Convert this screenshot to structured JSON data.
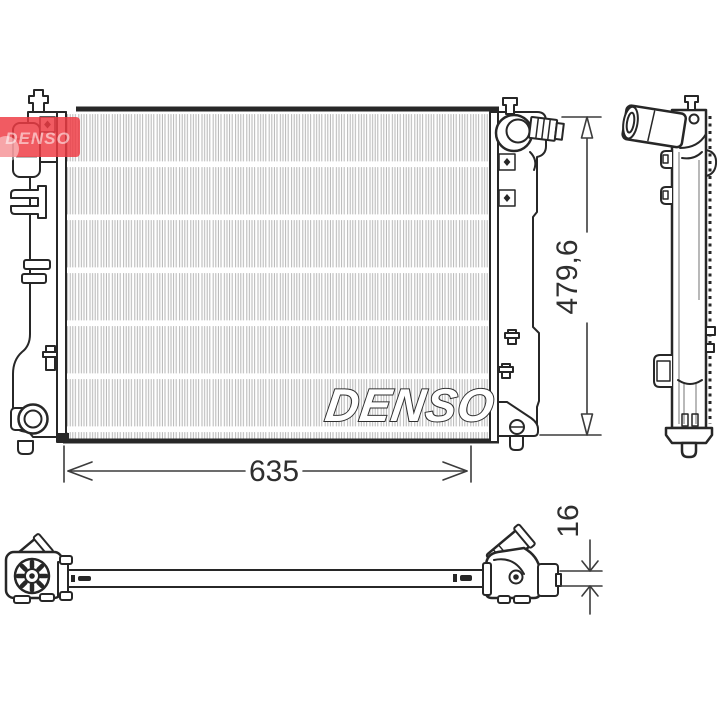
{
  "brand": {
    "logo_text": "DENSO",
    "watermark_text": "DENSO"
  },
  "dimensions": {
    "width_label": "635",
    "height_label": "479,6",
    "thickness_label": "16"
  },
  "colors": {
    "line": "#272727",
    "core_hatch": "#b5b5b5",
    "logo_red": "#ee3c44",
    "dim": "#3c3c3c",
    "background": "#ffffff"
  }
}
